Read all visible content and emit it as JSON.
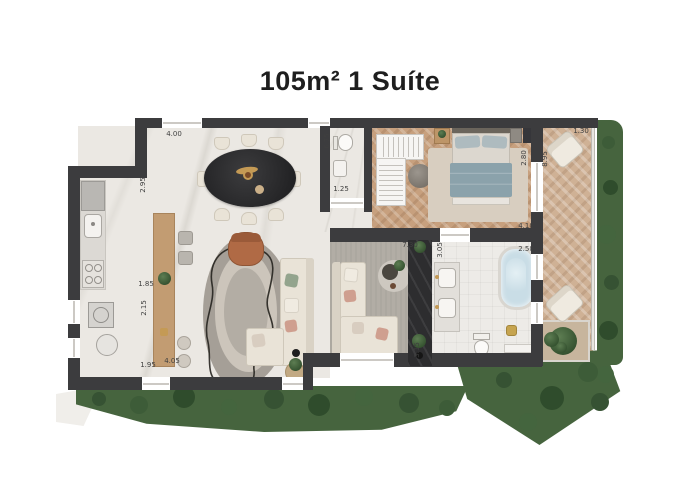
{
  "title": "105m² 1 Suíte",
  "palette": {
    "wall": "#3c3c3e",
    "stone": "#2d2d2f",
    "marble": "#ebe8e3",
    "tile": "#edebe7",
    "wood": "#c7a07e",
    "wood_light": "#cfb195",
    "gray_floor": "#b2ada5",
    "sofa": "#e9e3d7",
    "armchair": "#b06a45",
    "bed_duvet": "#8ba2ab",
    "water": "#c9dde6",
    "green": "#46643e",
    "green_dark": "#34512f",
    "green_light": "#5d7d52",
    "gold": "#c49a55",
    "dim_text": "#3f3f3f"
  },
  "dimensions": [
    {
      "label": "4.00",
      "x": 174,
      "y": 134
    },
    {
      "label": "2.95",
      "x": 143,
      "y": 185,
      "v": 1
    },
    {
      "label": "6.75",
      "x": 327,
      "y": 141,
      "v": 1
    },
    {
      "label": "1.25",
      "x": 341,
      "y": 189
    },
    {
      "label": "1.30",
      "x": 581,
      "y": 131
    },
    {
      "label": "8.95",
      "x": 545,
      "y": 159,
      "v": 1
    },
    {
      "label": "2.80",
      "x": 524,
      "y": 158,
      "v": 1
    },
    {
      "label": "4.10",
      "x": 526,
      "y": 226
    },
    {
      "label": "7.30",
      "x": 410,
      "y": 245
    },
    {
      "label": "3.05",
      "x": 440,
      "y": 250,
      "v": 1
    },
    {
      "label": "2.50",
      "x": 526,
      "y": 249
    },
    {
      "label": "3.15",
      "x": 417,
      "y": 350,
      "v": 1
    },
    {
      "label": "1.85",
      "x": 146,
      "y": 284
    },
    {
      "label": "2.15",
      "x": 144,
      "y": 308,
      "v": 1
    },
    {
      "label": "1.95",
      "x": 148,
      "y": 365
    },
    {
      "label": "4.05",
      "x": 172,
      "y": 361
    }
  ]
}
